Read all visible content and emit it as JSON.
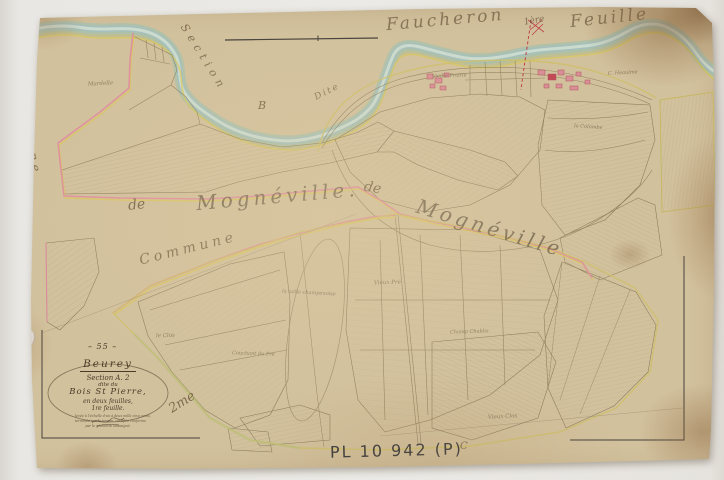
{
  "inscriptions": {
    "top": {
      "word1": "Faucheron",
      "word2": "1ère",
      "word3": "Feuille"
    },
    "section_diagonal": "Section",
    "dite": "Dite",
    "letter_b": "B",
    "letter_c": "C",
    "commune_vertical": "Commune",
    "commune_diagonal": "Commune",
    "de_1": "de",
    "mogneville_1": "Mognéville.",
    "de_2": "de",
    "mogneville_2": "Mognéville",
    "sheet_2me": "2me"
  },
  "cartouche": {
    "number": "– 55 –",
    "commune_title": "Beurey",
    "section_line": "Section A. 2",
    "dite_line": "dite du",
    "name_line": "Bois St Pierre,",
    "sheets_line": "en deux feuilles,",
    "sheet_line": "1re feuille.",
    "fine_print_illegible": [
      "levée à l'échelle d'un à deux mille cinq cents,",
      "terminée sur le terrain, certifiée conforme",
      "par le géomètre soussigné."
    ]
  },
  "stamp": "PL 10 942 (P)",
  "parcel_labels": [
    {
      "text": "Mardelle",
      "x": 88,
      "y": 82,
      "rot": -3,
      "size": 5.5
    },
    {
      "text": "Vieille Prairie",
      "x": 432,
      "y": 74,
      "rot": -2,
      "size": 5
    },
    {
      "text": "C. Heaulme",
      "x": 608,
      "y": 71,
      "rot": -3,
      "size": 5
    },
    {
      "text": "la Colombe",
      "x": 574,
      "y": 125,
      "rot": 4,
      "size": 5
    },
    {
      "text": "Vieux Pré",
      "x": 374,
      "y": 281,
      "rot": -2,
      "size": 5.5
    },
    {
      "text": "la taille champenoise",
      "x": 282,
      "y": 291,
      "rot": 3,
      "size": 5
    },
    {
      "text": "le Clos",
      "x": 156,
      "y": 334,
      "rot": -2,
      "size": 5.5
    },
    {
      "text": "Couchant du Pré",
      "x": 232,
      "y": 352,
      "rot": 2,
      "size": 5
    },
    {
      "text": "Champ Chablis",
      "x": 450,
      "y": 330,
      "rot": -2,
      "size": 5
    },
    {
      "text": "Vieux Clos",
      "x": 488,
      "y": 415,
      "rot": -3,
      "size": 5.5
    }
  ],
  "colors": {
    "paper": "#d2c19d",
    "boundary_pink": "#e08ca0",
    "boundary_yellow": "#d9c75c",
    "river_blue": "#9fbfc4",
    "ink": "#6a563c",
    "stamp_ink": "#2c2d34"
  }
}
